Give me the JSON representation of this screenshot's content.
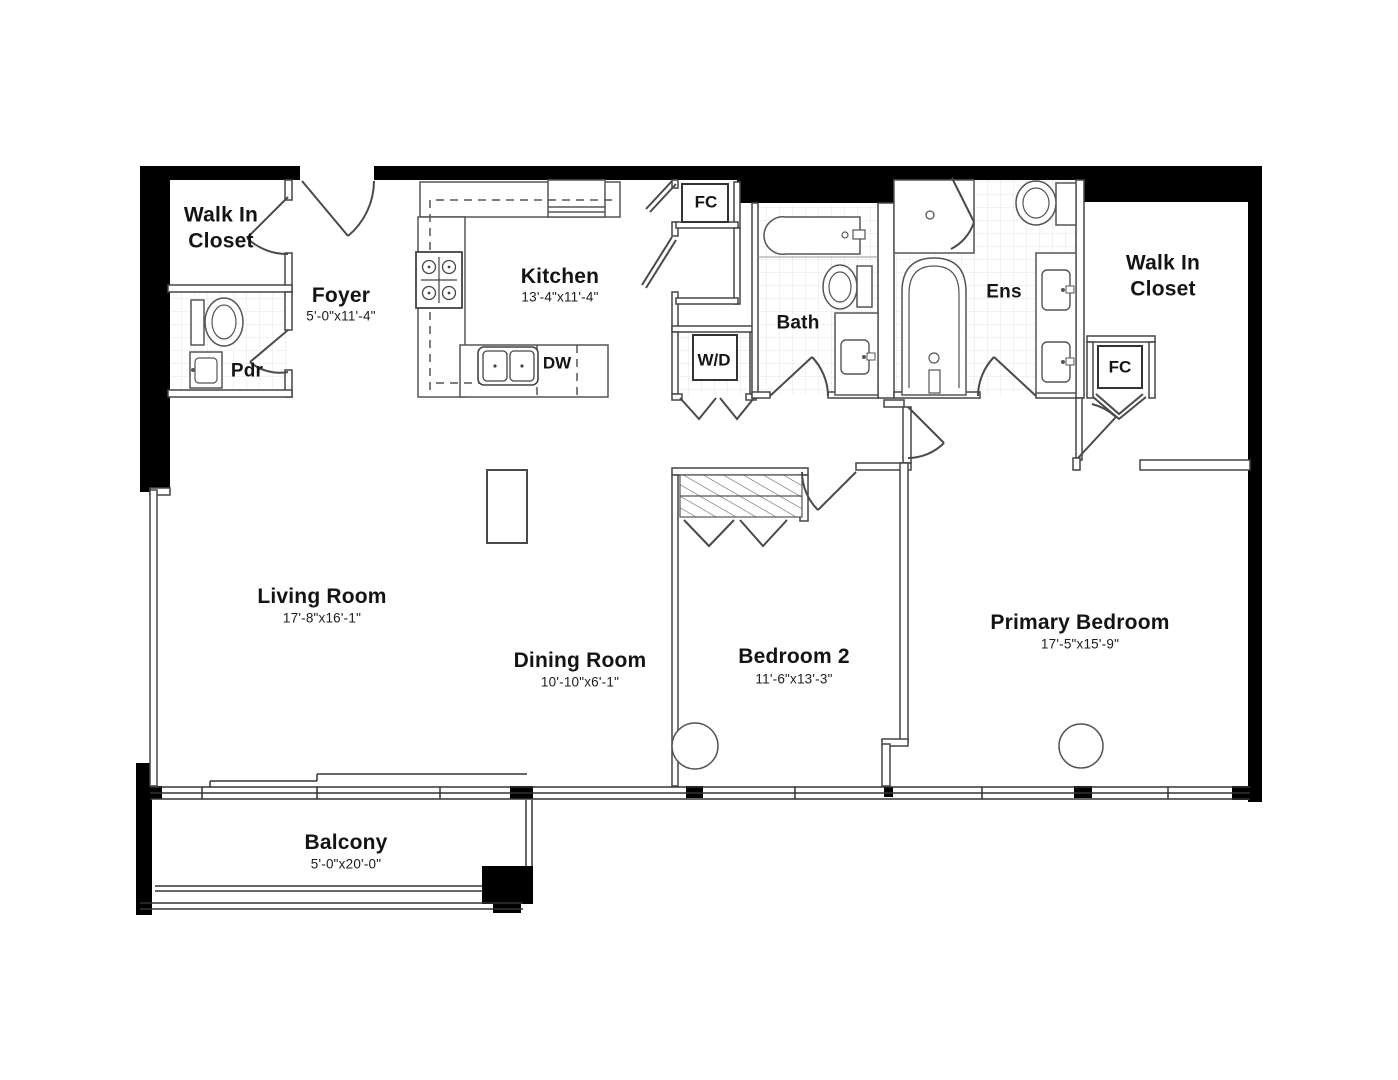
{
  "plan_type": "apartment-floor-plan",
  "colors": {
    "background": "#ffffff",
    "walls_solid": "#000000",
    "walls_partition": "#454545",
    "fixtures": "#555555",
    "tile_grid": "#e4e4e4",
    "text": "#141414"
  },
  "rooms": {
    "walk_in_closet_left": {
      "name": "Walk In\nCloset"
    },
    "foyer": {
      "name": "Foyer",
      "dims": "5'-0\"x11'-4\""
    },
    "kitchen": {
      "name": "Kitchen",
      "dims": "13'-4\"x11'-4\""
    },
    "powder_room": {
      "name": "Pdr"
    },
    "bath": {
      "name": "Bath"
    },
    "ensuite": {
      "name": "Ens"
    },
    "walk_in_closet_right": {
      "name": "Walk In\nCloset"
    },
    "living_room": {
      "name": "Living Room",
      "dims": "17'-8\"x16'-1\""
    },
    "dining_room": {
      "name": "Dining Room",
      "dims": "10'-10\"x6'-1\""
    },
    "bedroom_2": {
      "name": "Bedroom 2",
      "dims": "11'-6\"x13'-3\""
    },
    "primary_bedroom": {
      "name": "Primary Bedroom",
      "dims": "17'-5\"x15'-9\""
    },
    "balcony": {
      "name": "Balcony",
      "dims": "5'-0\"x20'-0\""
    }
  },
  "features": {
    "fan_coil_1": {
      "label": "FC"
    },
    "fan_coil_2": {
      "label": "FC"
    },
    "dishwasher": {
      "label": "DW"
    },
    "washer_dryer": {
      "label": "W/D"
    }
  }
}
